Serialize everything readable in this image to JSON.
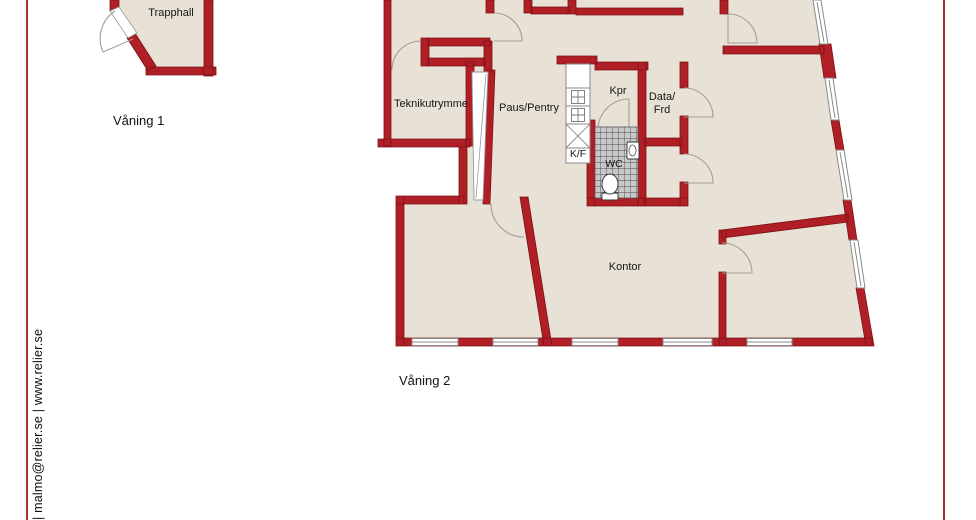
{
  "branding": {
    "contact_text": "| malmo@relier.se | www.relier.se"
  },
  "floor1": {
    "caption": "Våning 1",
    "rooms": {
      "trapphall": "Trapphall"
    }
  },
  "floor2": {
    "caption": "Våning 2",
    "rooms": {
      "teknikutrymme": "Teknikutrymme",
      "paus_pentry": "Paus/Pentry",
      "kpr": "Kpr",
      "data_frd_line1": "Data/",
      "data_frd_line2": "Frd",
      "kf": "K/F",
      "wc": "WC",
      "kontor": "Kontor"
    }
  },
  "colors": {
    "wall_fill": "#b01e26",
    "wall_outline": "#7d1216",
    "floor_fill": "#e8e2d6",
    "tile_fill": "#c8c8c8",
    "page_rule": "#a33231",
    "door_arc": "#a39d94"
  }
}
